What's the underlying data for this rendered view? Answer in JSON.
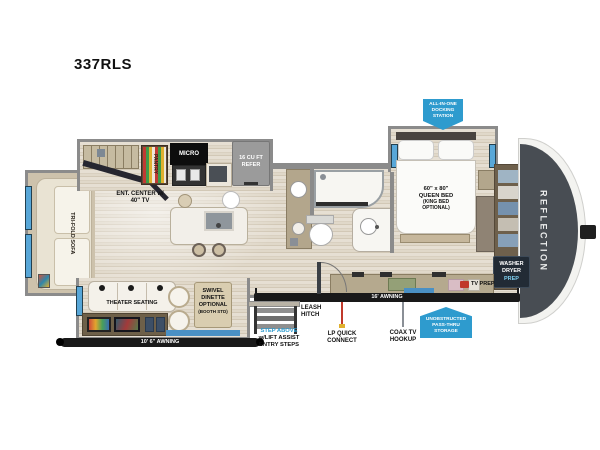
{
  "title": "337RLS",
  "colors": {
    "badge_blue": "#2E9BCE",
    "window_blue": "#58A7D8",
    "awning_black": "#191919",
    "front_cap_gray": "#484D53",
    "lp_line_red": "#C0392B"
  },
  "labels": {
    "ent_center": [
      "ENT. CENTER w/",
      "40\" TV"
    ],
    "tri_fold_sofa": "TRI-FOLD SOFA",
    "pantry": "PANTRY",
    "micro": "MICRO",
    "refer": [
      "16 CU FT",
      "REFER"
    ],
    "theater_seating": "THEATER SEATING",
    "swivel_dinette": [
      "SWIVEL",
      "DINETTE",
      "OPTIONAL",
      "(BOOTH STD)"
    ],
    "queen_bed": [
      "60\" x 80\"",
      "QUEEN BED",
      "(KING BED",
      "OPTIONAL)"
    ],
    "washer_dryer_prep": [
      "WASHER",
      "DRYER",
      "PREP"
    ],
    "tv_prep": "TV PREP",
    "reflection": "REFLECTION",
    "awning_rear": "10' 6\" AWNING",
    "awning_main": "16' AWNING",
    "leash_hitch": [
      "LEASH",
      "HITCH"
    ],
    "entry_steps": [
      "STEP ABOVE",
      "w/LIFT ASSIST",
      "ENTRY STEPS"
    ],
    "lp_quick_connect": [
      "LP QUICK",
      "CONNECT"
    ],
    "coax_tv_hookup": [
      "COAX TV",
      "HOOKUP"
    ],
    "docking_station": [
      "ALL-IN-ONE",
      "DOCKING",
      "STATION"
    ],
    "pass_thru_storage": [
      "UNOBSTRUCTED",
      "PASS-THRU",
      "STORAGE"
    ]
  }
}
